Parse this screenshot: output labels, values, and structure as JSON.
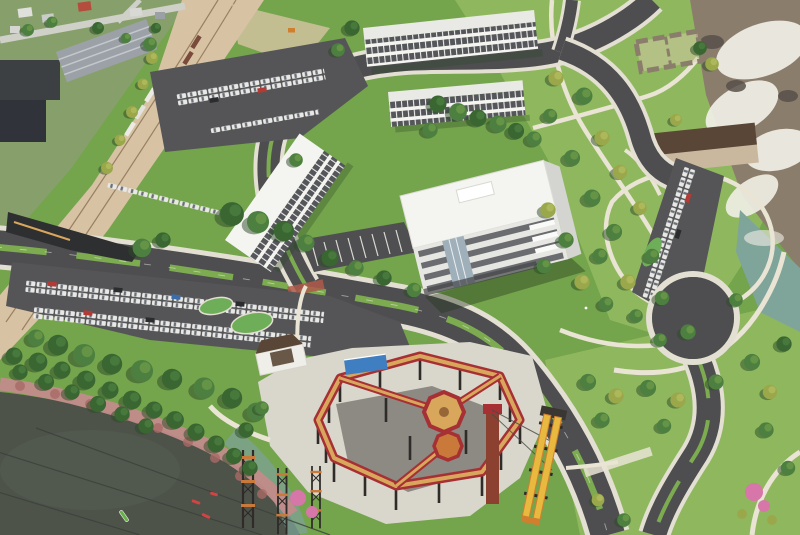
{
  "scene": {
    "type": "aerial-architectural-rendering",
    "description": "Aerial rendering of a riverfront mixed-use campus: white mid-rise buildings and curving boulevards with parking lots, an existing neighborhood and rail corridor at upper left, a park with stone ruins and waterfalls at right, a dark lake with kayaks at lower left, and a red adventure ropes course with climbing towers and yellow slides at bottom center"
  },
  "features": {
    "top_left": "existing neighborhood and industrial buildings along a diagonal rail corridor",
    "center": "new campus of white slab buildings with ribbon windows, loop road and boulevard",
    "right": "park lawns with winding paths, stone ruins, overlook building, waterfalls and river",
    "bottom_left": "lake with rocky pink shoreline, power lines and kayaks",
    "bottom_center": "red elevated ropes course on black posts with central tower, lattice climbing towers, blue canopy and yellow tube slides",
    "parking": "three car-filled lots and a circular turnaround drive"
  },
  "counts": {
    "kayaks": 4,
    "parking_lots": 3,
    "campus_buildings": 5,
    "slides": 2
  },
  "colors": {
    "campusGrass": "#74a44c",
    "parkGrass": "#8fb85e",
    "nbhdGround": "#87a06b",
    "dirt": "#d7c3a4",
    "rail": "#8a6f52",
    "pavement": "#cfd0c8",
    "asphalt": "#4e4e50",
    "asphaltLot": "#555557",
    "sidewalk": "#e3dfd2",
    "medianGreen": "#7cab50",
    "islandGreen": "#6fae58",
    "path": "#e9e4d4",
    "laneWhite": "#f5f5f0",
    "roof": "#e9e9e5",
    "roofBright": "#f4f4f0",
    "facade": "#e6e6e2",
    "windowBand": "#54565a",
    "windowMullion": "#ebebe9",
    "glass": "#9fb0ba",
    "bridge": "#2e2f31",
    "brick": "#b05a49",
    "rock": "#8b7d6c",
    "rockDark": "#57504a",
    "whitewater": "#f1efe7",
    "river": "#7fa49a",
    "lake": "#4d5349",
    "shallow": "#7da195",
    "shoreRock": "#c28c8a",
    "shoreRockDark": "#a96a67",
    "wire": "#3c403c",
    "kayakGreen": "#69b04a",
    "kayakRed": "#cf4444",
    "concrete": "#d9d6cb",
    "post": "#2e2b28",
    "courseRed": "#a63034",
    "courseTan": "#d9a75c",
    "courseOrange": "#c97a3a",
    "rust": "#8c4030",
    "canopyBlue": "#3f7fc1",
    "hqRoof": "#5a4636",
    "slideYellow": "#e8b93e",
    "slideOrange": "#d07f2e",
    "pink": "#d776a8",
    "treeDark": "#3a6632",
    "treeMid": "#4d8040",
    "treeLight": "#6f9c4a",
    "treeYellow": "#9aa84b",
    "treeYellowHi": "#b5bf62",
    "treeShadow": "#2c4a26",
    "warehouse": "#9ba1a6",
    "indRoof1": "#3c4043",
    "indRoof2": "#30343a",
    "carBody": "#e8e8e6",
    "carGlass": "#6a7076",
    "carRed": "#b23b35",
    "carBlue": "#3c6da8",
    "carDark": "#2a2c2e",
    "boxcarBrown": "#7a4a3a",
    "white": "#ffffff"
  }
}
